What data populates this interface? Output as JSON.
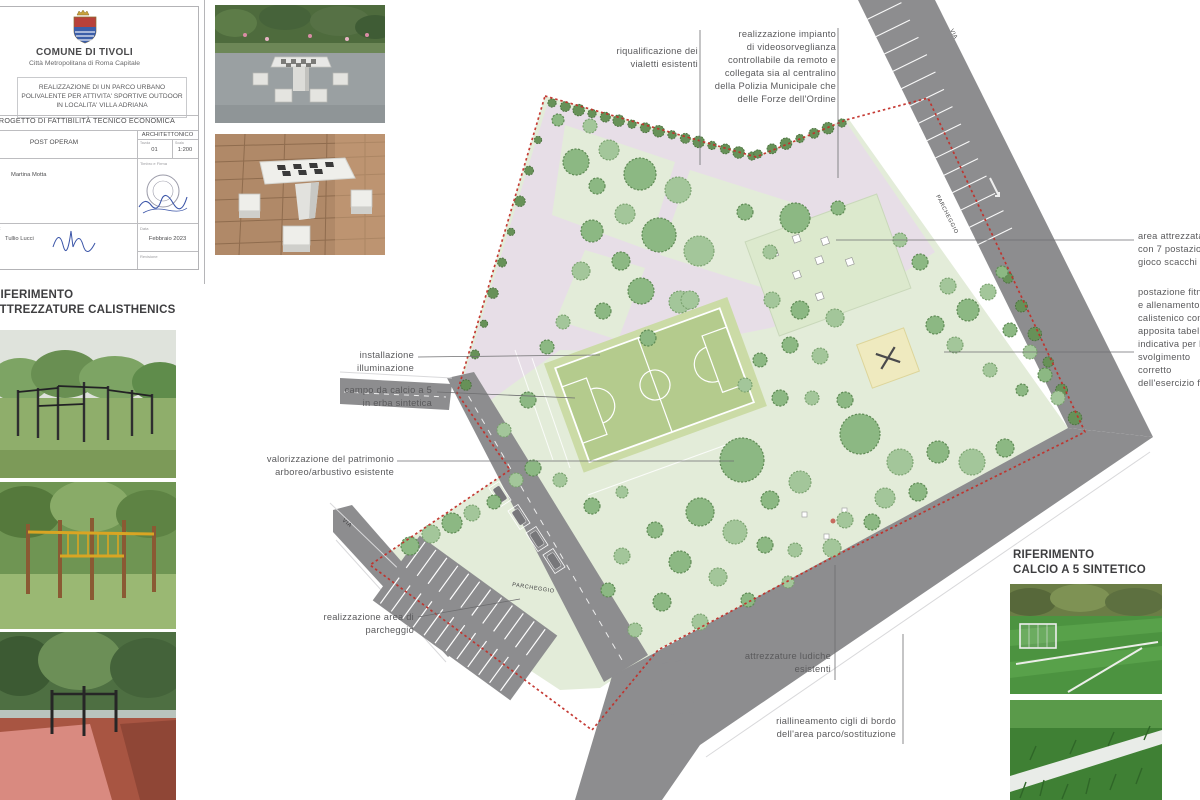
{
  "title_block": {
    "municipality": "COMUNE DI TIVOLI",
    "subtitle": "Città Metropolitana di Roma Capitale",
    "project_title": "REALIZZAZIONE DI UN PARCO URBANO POLIVALENTE PER ATTIVITA' SPORTIVE OUTDOOR IN LOCALITA' VILLA ADRIANA",
    "document_type": "PROGETTO DI FATTIBILITÀ TECNICO ECONOMICA",
    "phase_label": "Fase",
    "phase": "POST OPERAM",
    "category": "ARCHITETTONICO",
    "sheet_label": "Tavola",
    "sheet_number": "01",
    "scale_label": "Scala",
    "scale": "1:200",
    "designer_label": "Progettista",
    "designer": "Martina Motta",
    "stamp_label": "Timbro e Firma",
    "manager_label": "Il Dirigente U.T.",
    "manager": "Tullio Lucci",
    "manager_note": "Arch.",
    "date_label": "Data",
    "date": "Febbraio 2023",
    "revision_label": "Revisione"
  },
  "references": {
    "calisthenics_line1": "RIFERIMENTO",
    "calisthenics_line2": "ATTREZZATURE CALISTHENICS",
    "calcio_line1": "RIFERIMENTO",
    "calcio_line2": "CALCIO A 5 SINTETICO"
  },
  "plan_labels": {
    "road_parking": "PARCHEGGIO",
    "lot_parking": "PARCHEGGIO",
    "street_top": "VIA",
    "street_left": "VIA"
  },
  "annotations": [
    {
      "id": "riqualificazione-vialetti",
      "lines": [
        "riqualificazione dei",
        "vialetti esistenti"
      ]
    },
    {
      "id": "videosorveglianza",
      "lines": [
        "realizzazione impianto",
        "di videosorveglianza",
        "controllabile da remoto e",
        "collegata sia al centralino",
        "della Polizia Municipale che",
        "delle Forze dell'Ordine"
      ]
    },
    {
      "id": "area-scacchi",
      "lines": [
        "area attrezzata",
        "con 7 postazioni",
        "gioco scacchi"
      ]
    },
    {
      "id": "postazione-fitness",
      "lines": [
        "postazione fitness",
        "e allenamento",
        "calistenico con",
        "apposita tabella",
        "indicativa per lo",
        "svolgimento",
        "corretto",
        "dell'esercizio fisico"
      ]
    },
    {
      "id": "illuminazione",
      "lines": [
        "installazione",
        "illuminazione"
      ]
    },
    {
      "id": "campo-calcio",
      "lines": [
        "campo da calcio a 5",
        "in erba sintetica"
      ]
    },
    {
      "id": "valorizzazione-patrimonio",
      "lines": [
        "valorizzazione del patrimonio",
        "arboreo/arbustivo esistente"
      ]
    },
    {
      "id": "area-parcheggio",
      "lines": [
        "realizzazione area di",
        "parcheggio"
      ]
    },
    {
      "id": "attrezzature-ludiche",
      "lines": [
        "attrezzature ludiche",
        "esistenti"
      ]
    },
    {
      "id": "riallineamento-cigli",
      "lines": [
        "riallineamento cigli di bordo",
        "dell'area parco/sostituzione"
      ]
    }
  ]
}
